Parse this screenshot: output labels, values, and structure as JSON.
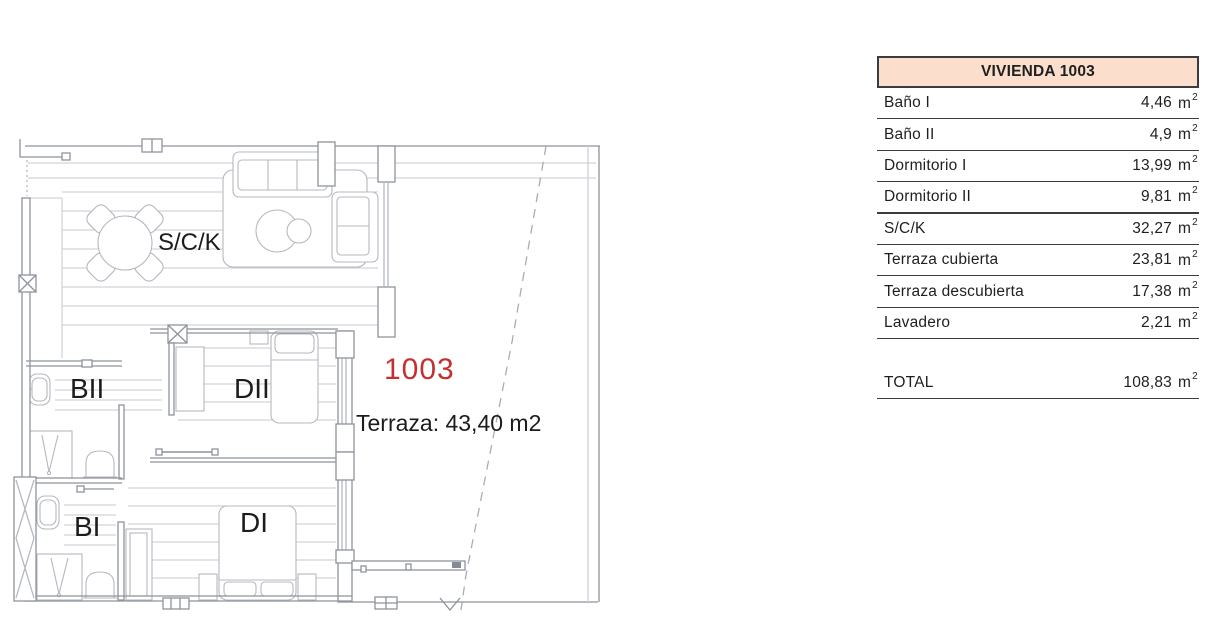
{
  "plan": {
    "unit_number": "1003",
    "unit_number_color": "#c4302f",
    "terrace_note": "Terraza: 43,40 m2",
    "room_labels": {
      "sck": "S/C/K",
      "banio2": "BII",
      "dorm2": "DII",
      "banio1": "BI",
      "dorm1": "DI"
    },
    "line_colors": {
      "wall": "#8e939c",
      "floor": "#c7cad0",
      "furniture": "#b4b8bf"
    }
  },
  "table": {
    "title": "VIVIENDA 1003",
    "header_bg": "#fbdfcc",
    "border_color": "#3c3c3c",
    "unit_base": "m",
    "unit_sup": "2",
    "rows": [
      {
        "label": "Baño I",
        "value": "4,46"
      },
      {
        "label": "Baño II",
        "value": "4,9"
      },
      {
        "label": "Dormitorio I",
        "value": "13,99"
      },
      {
        "label": "Dormitorio II",
        "value": "9,81"
      },
      {
        "label": "S/C/K",
        "value": "32,27"
      },
      {
        "label": "Terraza cubierta",
        "value": "23,81"
      },
      {
        "label": "Terraza descubierta",
        "value": "17,38"
      },
      {
        "label": "Lavadero",
        "value": "2,21"
      }
    ],
    "total": {
      "label": "TOTAL",
      "value": "108,83"
    }
  }
}
